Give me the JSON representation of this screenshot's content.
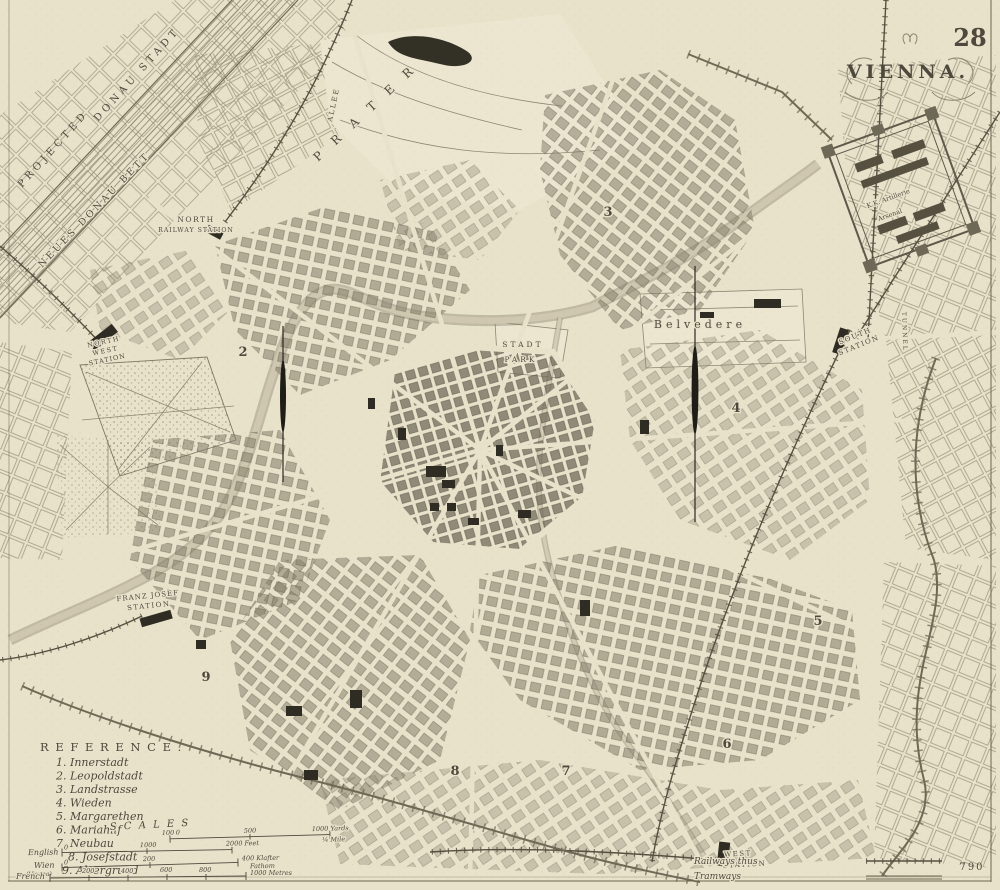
{
  "page": {
    "number": "28",
    "plate": "790"
  },
  "title": {
    "text": "VIENNA."
  },
  "map_labels": {
    "neues_donau_bett": "NEUES DONAU BETT",
    "projected": "PROJECTED",
    "donau_stadt": "DONAU STADT",
    "prater": "P R A T E R",
    "allee": "ALLEE",
    "north_station_1": "NORTH",
    "north_station_2": "RAILWAY STATION",
    "northwest_station_1": "NORTH",
    "northwest_station_2": "WEST",
    "northwest_station_3": "STATION",
    "franz_josef_1": "FRANZ JOSEF",
    "franz_josef_2": "STATION",
    "south_station_1": "SOUTH",
    "south_station_2": "STATION",
    "west_station_1": "WEST",
    "west_station_2": "STATION",
    "belvedere": "Belvedere",
    "stadt_park_1": "STADT",
    "stadt_park_2": "PARK",
    "arsenal_1": "K.K. Artillerie",
    "arsenal_2": "Arsenal",
    "tunnel": "TUNNEL"
  },
  "districts": [
    "2",
    "3",
    "4",
    "5",
    "6",
    "7",
    "8",
    "9"
  ],
  "reference": {
    "title": "R E F E R E N C E .",
    "items": [
      "1. Innerstadt",
      "2. Leopoldstadt",
      "3. Landstrasse",
      "4. Wieden",
      "5. Margarethen",
      "6. Mariahilf",
      "7. Neubau",
      "8. Josefstadt",
      "9. Alsergrund"
    ]
  },
  "scales": {
    "title": "S C A L E S",
    "yards": {
      "t1": "100",
      "t2": "0",
      "t3": "500",
      "t4": "1000 Yards",
      "t5": "¼ Mile"
    },
    "english": {
      "name": "English",
      "t1": "0",
      "t2": "1000",
      "t3": "2000 Feet"
    },
    "wien": {
      "name": "Wien",
      "name2": "(Vienna)",
      "t1": "0",
      "t2": "200",
      "t3": "400 Klafter",
      "t4": "Fathom"
    },
    "french": {
      "name": "French",
      "t1": "200",
      "t2": "400",
      "t3": "600",
      "t4": "800",
      "t5": "1000 Metres"
    },
    "railways_label": "Railways thus",
    "tramways_label": "Tramways"
  }
}
